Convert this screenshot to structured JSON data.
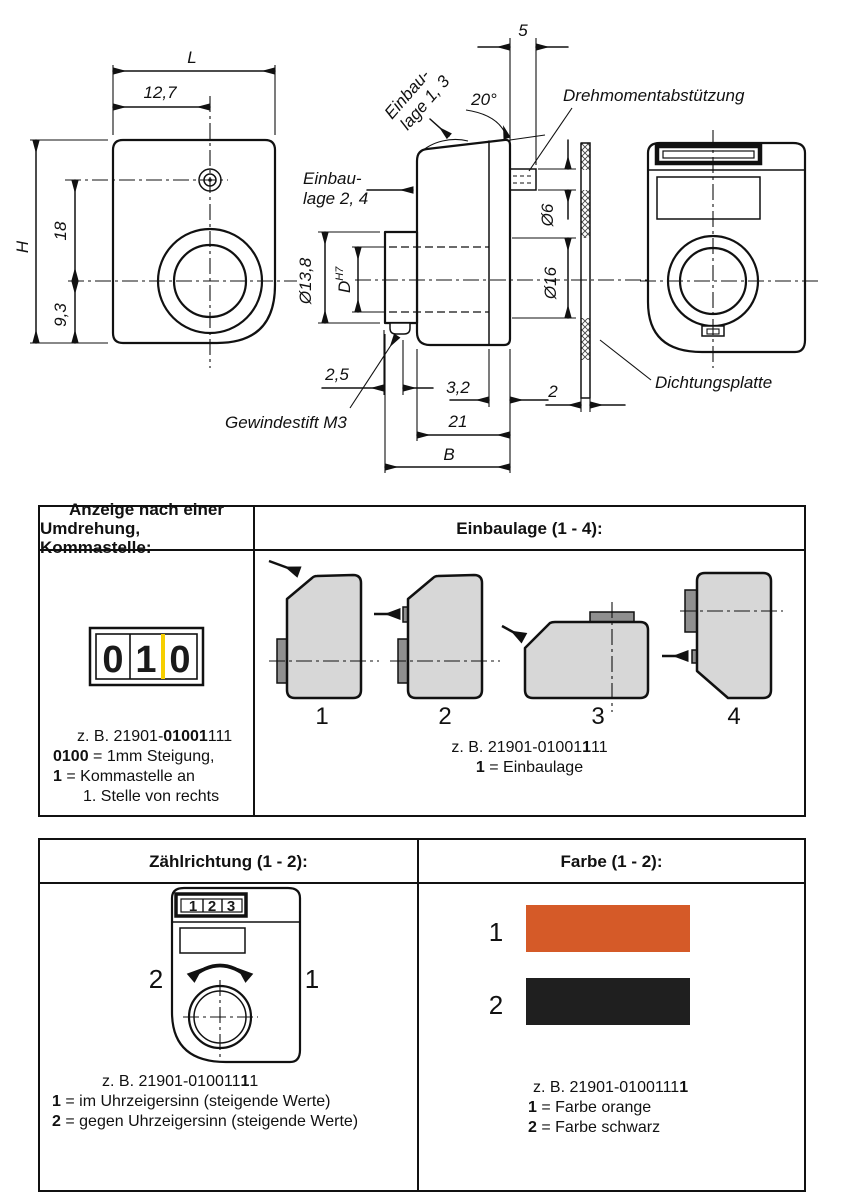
{
  "colors": {
    "line": "#111111",
    "orange": "#d55a28",
    "black": "#1f1f1f",
    "yellow": "#f6cf00",
    "device_gray": "#d7d7d7",
    "tab_gray": "#8f8f8f"
  },
  "drawing": {
    "front": {
      "dim_L": "L",
      "dim_127": "12,7",
      "dim_H": "H",
      "dim_18": "18",
      "dim_93": "9,3"
    },
    "side": {
      "dim_5": "5",
      "dim_20deg": "20°",
      "dim_dia6": "Ø6",
      "dim_dia16": "Ø16",
      "dim_dia138": "Ø13,8",
      "dim_D": "D",
      "dim_D_tol": "H7",
      "dim_25": "2,5",
      "dim_32": "3,2",
      "dim_21": "21",
      "dim_B": "B",
      "dim_2": "2",
      "label_einbaulage13_line1": "Einbau-",
      "label_einbaulage13_line2": "lage 1, 3",
      "label_einbaulage24_line1": "Einbau-",
      "label_einbaulage24_line2": "lage 2, 4",
      "label_drehmoment": "Drehmomentabstützung",
      "label_gewindestift": "Gewindestift M3"
    },
    "seal": {
      "label_dichtungsplatte": "Dichtungsplatte"
    }
  },
  "anzeige_table": {
    "anzeige": {
      "header_line1": "Anzeige nach einer",
      "header_line2": "Umdrehung, Kommastelle:",
      "counter_digits": [
        "0",
        "1",
        "0"
      ],
      "caption_line1": {
        "pre": "z. B. 21901-",
        "bold": "01001",
        "suf": "111"
      },
      "caption_line2": {
        "bold": "0100",
        "rest": " = 1mm Steigung,"
      },
      "caption_line3": {
        "bold": "1",
        "rest": " = Kommastelle an"
      },
      "caption_line4": "1. Stelle von rechts"
    },
    "einbaulage": {
      "header": "Einbaulage (1 - 4):",
      "position_labels": [
        "1",
        "2",
        "3",
        "4"
      ],
      "caption_line1": {
        "pre": "z. B. 21901-01001",
        "bold": "1",
        "suf": "11"
      },
      "caption_line2": {
        "bold": "1",
        "rest": " = Einbaulage"
      }
    }
  },
  "options_table": {
    "zaehlrichtung": {
      "header": "Zählrichtung (1 - 2):",
      "counter_digits": [
        "1",
        "2",
        "3"
      ],
      "label_ccw": "2",
      "label_cw": "1",
      "caption_line1": {
        "pre": "z. B.  21901-010011",
        "bold": "1",
        "suf": "1"
      },
      "caption_line2": {
        "bold": "1",
        "rest": " = im Uhrzeigersinn (steigende Werte)"
      },
      "caption_line3": {
        "bold": "2",
        "rest": " = gegen Uhrzeigersinn (steigende Werte)"
      }
    },
    "farbe": {
      "header": "Farbe (1 - 2):",
      "swatches": [
        {
          "label": "1",
          "color": "#d55a28",
          "name": "orange"
        },
        {
          "label": "2",
          "color": "#1f1f1f",
          "name": "schwarz"
        }
      ],
      "caption_line1": {
        "pre": "z. B.  21901-0100111",
        "bold": "1",
        "suf": ""
      },
      "caption_line2": {
        "bold": "1",
        "rest": " = Farbe orange"
      },
      "caption_line3": {
        "bold": "2",
        "rest": " = Farbe schwarz"
      }
    }
  }
}
